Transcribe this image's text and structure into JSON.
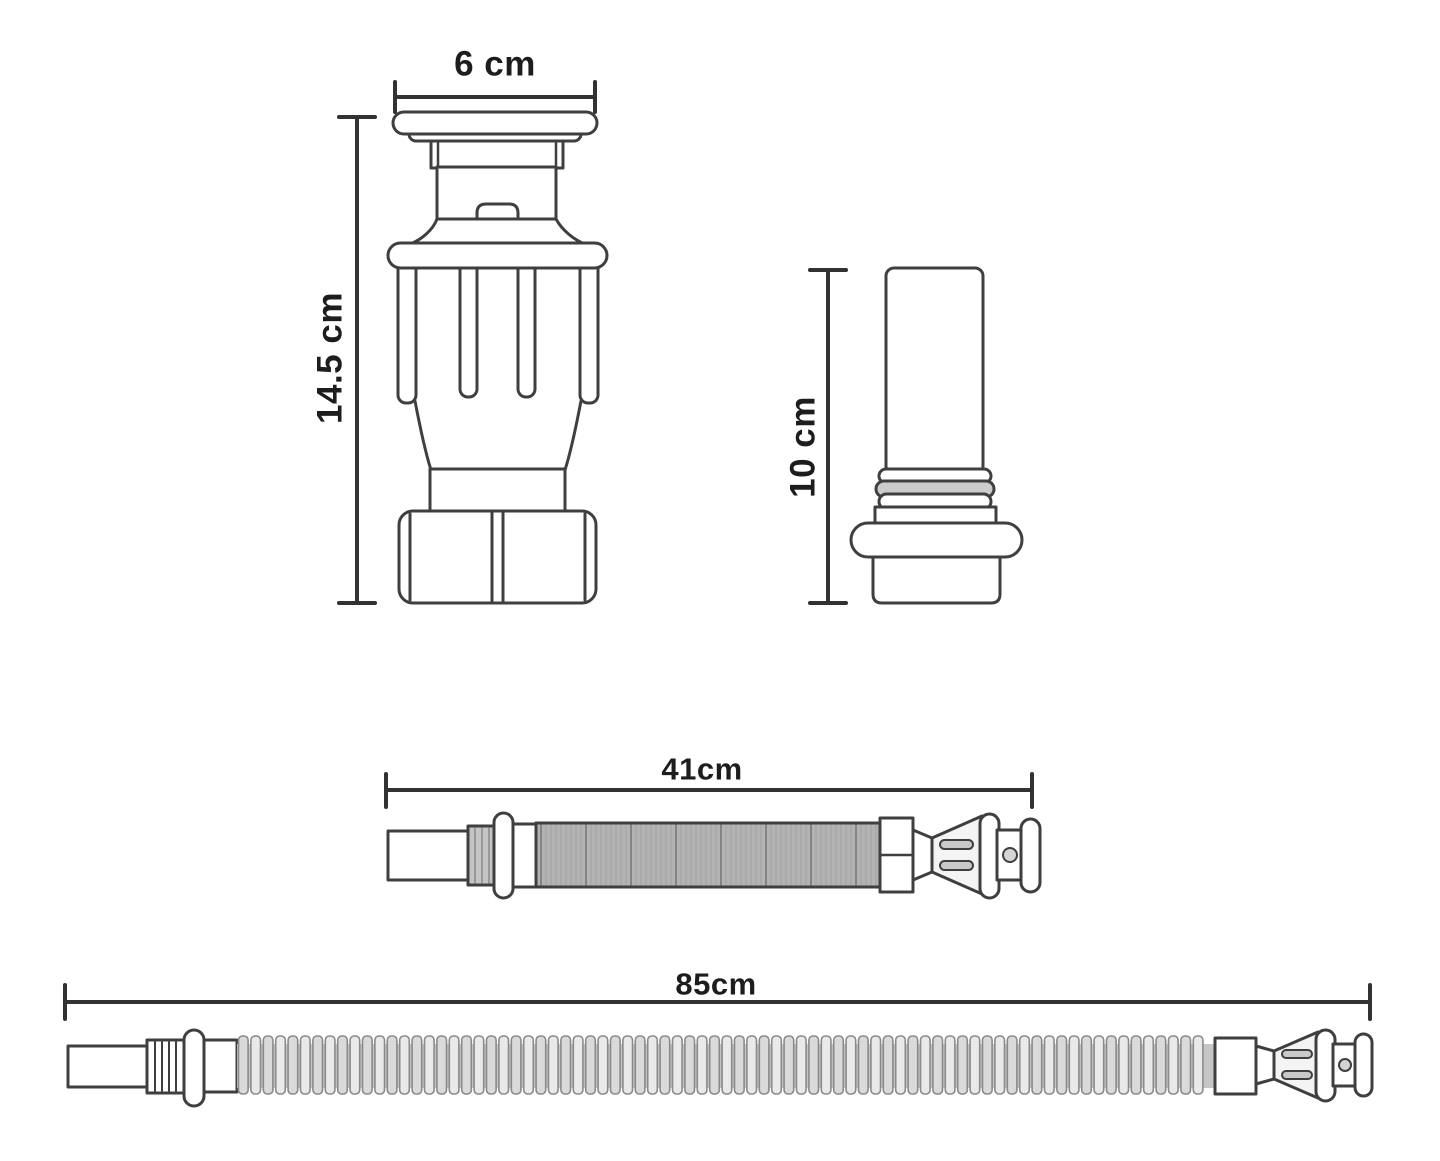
{
  "labels": {
    "drain_width": "6 cm",
    "drain_height": "14.5 cm",
    "extension_height": "10 cm",
    "short_hose_length": "41cm",
    "long_hose_length": "85cm"
  },
  "colors": {
    "background": "#ffffff",
    "outline": "#3f3f3f",
    "dimension_line": "#323232",
    "label_text": "#1d1d1d",
    "short_hose_fill": "#b3b3b3",
    "short_hose_stripe": "#a2a2a2",
    "short_hose_stripe_dark": "#848484",
    "long_hose_valley": "#c6c6c6",
    "long_hose_rib_light": "#e9e9e9",
    "long_hose_rib_dark": "#dadada",
    "long_hose_rib_stroke": "#8a8a8a",
    "thread_fill": "#c4c4c4",
    "detail_fill": "#cfcfcf"
  }
}
